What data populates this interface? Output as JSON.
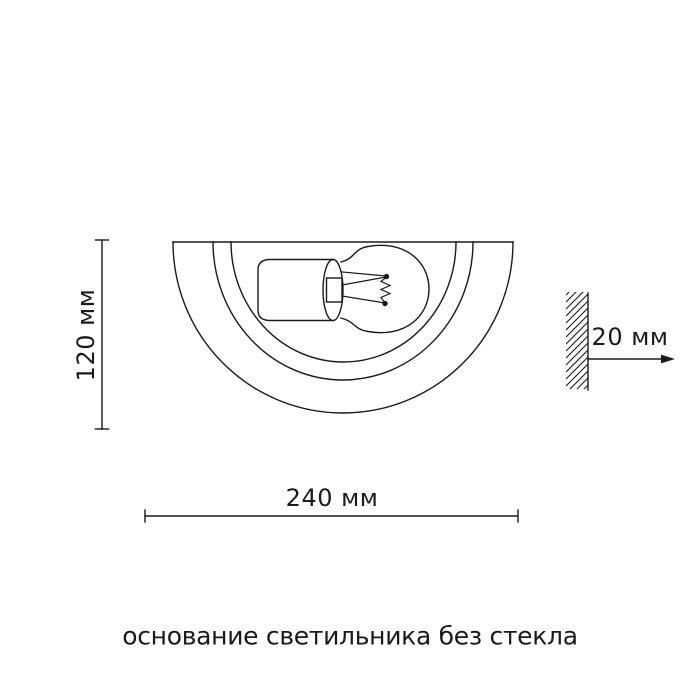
{
  "diagram": {
    "caption": "основание светильника без стекла",
    "dimensions": {
      "height": "120 мм",
      "width": "240 мм",
      "depth": "20 мм"
    },
    "colors": {
      "line": "#1a1a1a",
      "background": "#ffffff",
      "text": "#1a1a1a"
    }
  }
}
